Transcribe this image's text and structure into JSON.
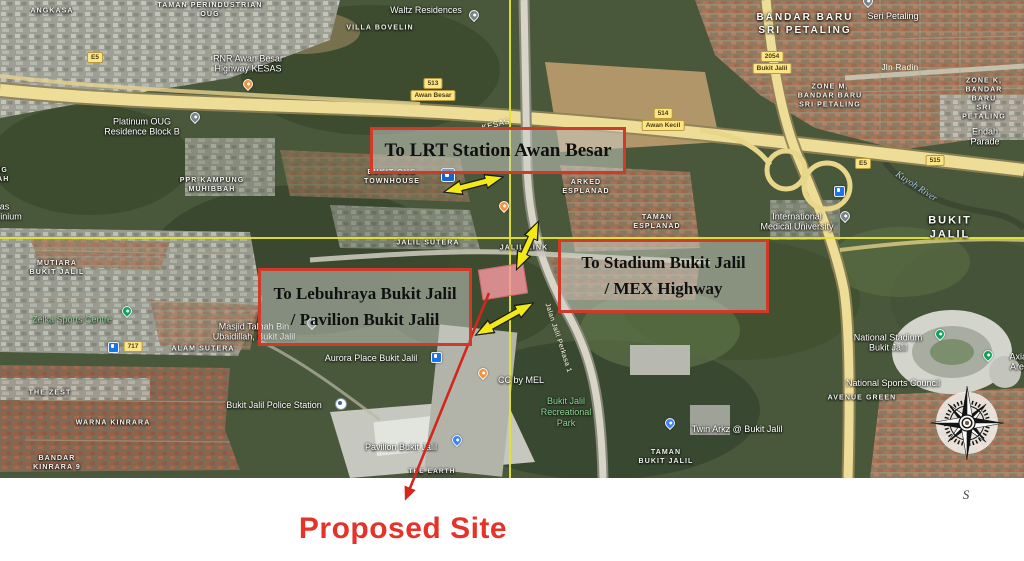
{
  "annotations": {
    "lrt_box": "To LRT Station Awan Besar",
    "stadium_box_line1": "To Stadium Bukit Jalil",
    "stadium_box_line2": "/ MEX Highway",
    "lebuhraya_box_line1": "To Lebuhraya Bukit Jalil",
    "lebuhraya_box_line2": "/ Pavilion Bukit Jalil",
    "proposed_site": "Proposed Site",
    "south": "S"
  },
  "colors": {
    "annotation_border": "#d13a28",
    "annotation_text_red": "#e63329",
    "arrow_yellow": "#f3ea15",
    "crosshair_yellow": "#e2e52f",
    "site_pink": "#f1979e"
  },
  "map": {
    "labels": [
      {
        "text": "TAMAN PERINDUSTRIAN\nOUG",
        "x": 210,
        "y": 10,
        "kind": "area"
      },
      {
        "text": "ANGKASA",
        "x": 52,
        "y": 11,
        "kind": "area"
      },
      {
        "text": "VILLA BOVELIN",
        "x": 380,
        "y": 28,
        "kind": "area"
      },
      {
        "text": "KAMPUNG\nMUHIBBAH",
        "x": -14,
        "y": 175,
        "kind": "area"
      },
      {
        "text": "PPR KAMPUNG\nMUHIBBAH",
        "x": 212,
        "y": 185,
        "kind": "area"
      },
      {
        "text": "BUKIT OUG\nTOWNHOUSE",
        "x": 392,
        "y": 177,
        "kind": "area"
      },
      {
        "text": "ARKED\nESPLANAD",
        "x": 586,
        "y": 187,
        "kind": "area"
      },
      {
        "text": "TAMAN\nESPLANAD",
        "x": 657,
        "y": 222,
        "kind": "area"
      },
      {
        "text": "MUTIARA\nBUKIT JALIL",
        "x": 57,
        "y": 268,
        "kind": "area"
      },
      {
        "text": "ALAM SUTERA",
        "x": 203,
        "y": 349,
        "kind": "area"
      },
      {
        "text": "THE ZEST",
        "x": 50,
        "y": 393,
        "kind": "area"
      },
      {
        "text": "WARNA KINRARA",
        "x": 113,
        "y": 423,
        "kind": "area"
      },
      {
        "text": "BANDAR\nKINRARA 9",
        "x": 57,
        "y": 463,
        "kind": "area"
      },
      {
        "text": "TAMAN\nBUKIT JALIL",
        "x": 666,
        "y": 457,
        "kind": "area"
      },
      {
        "text": "AVENUE GREEN",
        "x": 862,
        "y": 398,
        "kind": "area"
      },
      {
        "text": "ZONE M,\nBANDAR BARU\nSRI PETALING",
        "x": 830,
        "y": 96,
        "kind": "area"
      },
      {
        "text": "ZONE K,\nBANDAR BARU\nSRI PETALING",
        "x": 984,
        "y": 99,
        "kind": "area"
      },
      {
        "text": "JALIL SUTERA",
        "x": 428,
        "y": 243,
        "kind": "area"
      },
      {
        "text": "JALIL LINK",
        "x": 524,
        "y": 248,
        "kind": "area"
      },
      {
        "text": "THE EARTH",
        "x": 432,
        "y": 472,
        "kind": "area",
        "s": 6.5
      },
      {
        "text": "BANDAR BARU\nSRI PETALING",
        "x": 805,
        "y": 24,
        "kind": "arealg"
      },
      {
        "text": "BUKIT JALIL",
        "x": 950,
        "y": 228,
        "kind": "arealg",
        "s": 11
      },
      {
        "text": "Waltz Residences",
        "x": 426,
        "y": 10,
        "kind": "poi"
      },
      {
        "text": "RNR Awan Besar\nHighway KESAS",
        "x": 248,
        "y": 64,
        "kind": "poi"
      },
      {
        "text": "Platinum OUG\nResidence Block B",
        "x": 142,
        "y": 127,
        "kind": "poi"
      },
      {
        "text": "Seri Petaling",
        "x": 893,
        "y": 16,
        "kind": "poi"
      },
      {
        "text": "Endah Parade",
        "x": 985,
        "y": 137,
        "kind": "poi"
      },
      {
        "text": "International\nMedical University",
        "x": 797,
        "y": 222,
        "kind": "poi"
      },
      {
        "text": "Masjid Talhah Bin\nUbaidillah, Bukit Jalil",
        "x": 254,
        "y": 332,
        "kind": "poi"
      },
      {
        "text": "Aurora Place Bukit Jalil",
        "x": 371,
        "y": 358,
        "kind": "poi"
      },
      {
        "text": "Bukit Jalil Police Station",
        "x": 274,
        "y": 405,
        "kind": "poi"
      },
      {
        "text": "Pavilion Bukit Jalil",
        "x": 401,
        "y": 447,
        "kind": "poi"
      },
      {
        "text": "CC by MEL",
        "x": 521,
        "y": 380,
        "kind": "poi"
      },
      {
        "text": "Twin Arkz @ Bukit Jalil",
        "x": 737,
        "y": 429,
        "kind": "poi"
      },
      {
        "text": "National Stadium\nBukit Jalil",
        "x": 888,
        "y": 343,
        "kind": "poi"
      },
      {
        "text": "National Sports Council",
        "x": 893,
        "y": 383,
        "kind": "poi"
      },
      {
        "text": "Axiata Arena",
        "x": 1022,
        "y": 362,
        "kind": "poi"
      },
      {
        "text": "Sri Mas\nCondominium",
        "x": -6,
        "y": 212,
        "kind": "poi"
      },
      {
        "text": "Zelka Sports Centre",
        "x": 72,
        "y": 320,
        "kind": "green"
      },
      {
        "text": "Bukit Jalil\nRecreational\nPark",
        "x": 566,
        "y": 412,
        "kind": "green"
      },
      {
        "text": "Jln Radin",
        "x": 900,
        "y": 68,
        "kind": "road"
      },
      {
        "text": "KESAS",
        "x": 496,
        "y": 125,
        "kind": "road",
        "r": -14
      },
      {
        "text": "Jalan Jalil Perkasa 1",
        "x": 558,
        "y": 338,
        "kind": "road",
        "r": 72,
        "s": 7
      },
      {
        "text": "Kuyoh River",
        "x": 916,
        "y": 187,
        "kind": "water",
        "r": 33
      }
    ],
    "badges": [
      {
        "lines": [
          "513",
          "Awan Besar"
        ],
        "x": 433,
        "y": 78
      },
      {
        "lines": [
          "514",
          "Awan Kecil"
        ],
        "x": 663,
        "y": 108
      },
      {
        "lines": [
          "2054",
          "Bukit Jalil"
        ],
        "x": 772,
        "y": 51
      },
      {
        "lines": [
          "E5"
        ],
        "x": 95,
        "y": 52
      },
      {
        "lines": [
          "E5"
        ],
        "x": 863,
        "y": 158
      },
      {
        "lines": [
          "515"
        ],
        "x": 935,
        "y": 155
      },
      {
        "lines": [
          "717"
        ],
        "x": 133,
        "y": 341
      }
    ],
    "pins": [
      {
        "x": 474,
        "y": 21,
        "c": "#77838b",
        "name": "place-pin-icon"
      },
      {
        "x": 248,
        "y": 90,
        "c": "#f0953f",
        "name": "restaurant-pin-icon"
      },
      {
        "x": 195,
        "y": 123,
        "c": "#77838b",
        "name": "place-pin-icon"
      },
      {
        "x": 868,
        "y": 7,
        "c": "#77838b",
        "name": "mosque-pin-icon"
      },
      {
        "x": 127,
        "y": 317,
        "c": "#12a05f",
        "name": "sports-pin-icon"
      },
      {
        "x": 312,
        "y": 329,
        "c": "#77838b",
        "name": "mosque-pin-icon"
      },
      {
        "x": 457,
        "y": 446,
        "c": "#3e82f7",
        "name": "shopping-pin-icon"
      },
      {
        "x": 483,
        "y": 379,
        "c": "#f0953f",
        "name": "restaurant-pin-icon"
      },
      {
        "x": 670,
        "y": 429,
        "c": "#3e82f7",
        "name": "shopping-pin-icon"
      },
      {
        "x": 940,
        "y": 340,
        "c": "#12a05f",
        "name": "stadium-pin-icon"
      },
      {
        "x": 988,
        "y": 361,
        "c": "#12a05f",
        "name": "arena-pin-icon"
      },
      {
        "x": 845,
        "y": 222,
        "c": "#77838b",
        "name": "university-pin-icon"
      },
      {
        "x": 504,
        "y": 212,
        "c": "#f0953f",
        "name": "restaurant-pin-icon"
      }
    ],
    "icons": [
      {
        "x": 838,
        "y": 190,
        "t": "ticon",
        "name": "transit-station-icon"
      },
      {
        "x": 435,
        "y": 356,
        "t": "ticon",
        "name": "transit-station-icon"
      },
      {
        "x": 112,
        "y": 346,
        "t": "ticon",
        "name": "transit-station-icon"
      },
      {
        "x": 447,
        "y": 174,
        "t": "lrticon",
        "name": "lrt-station-icon"
      },
      {
        "x": 340,
        "y": 403,
        "t": "policeicon",
        "name": "police-station-icon"
      }
    ]
  }
}
